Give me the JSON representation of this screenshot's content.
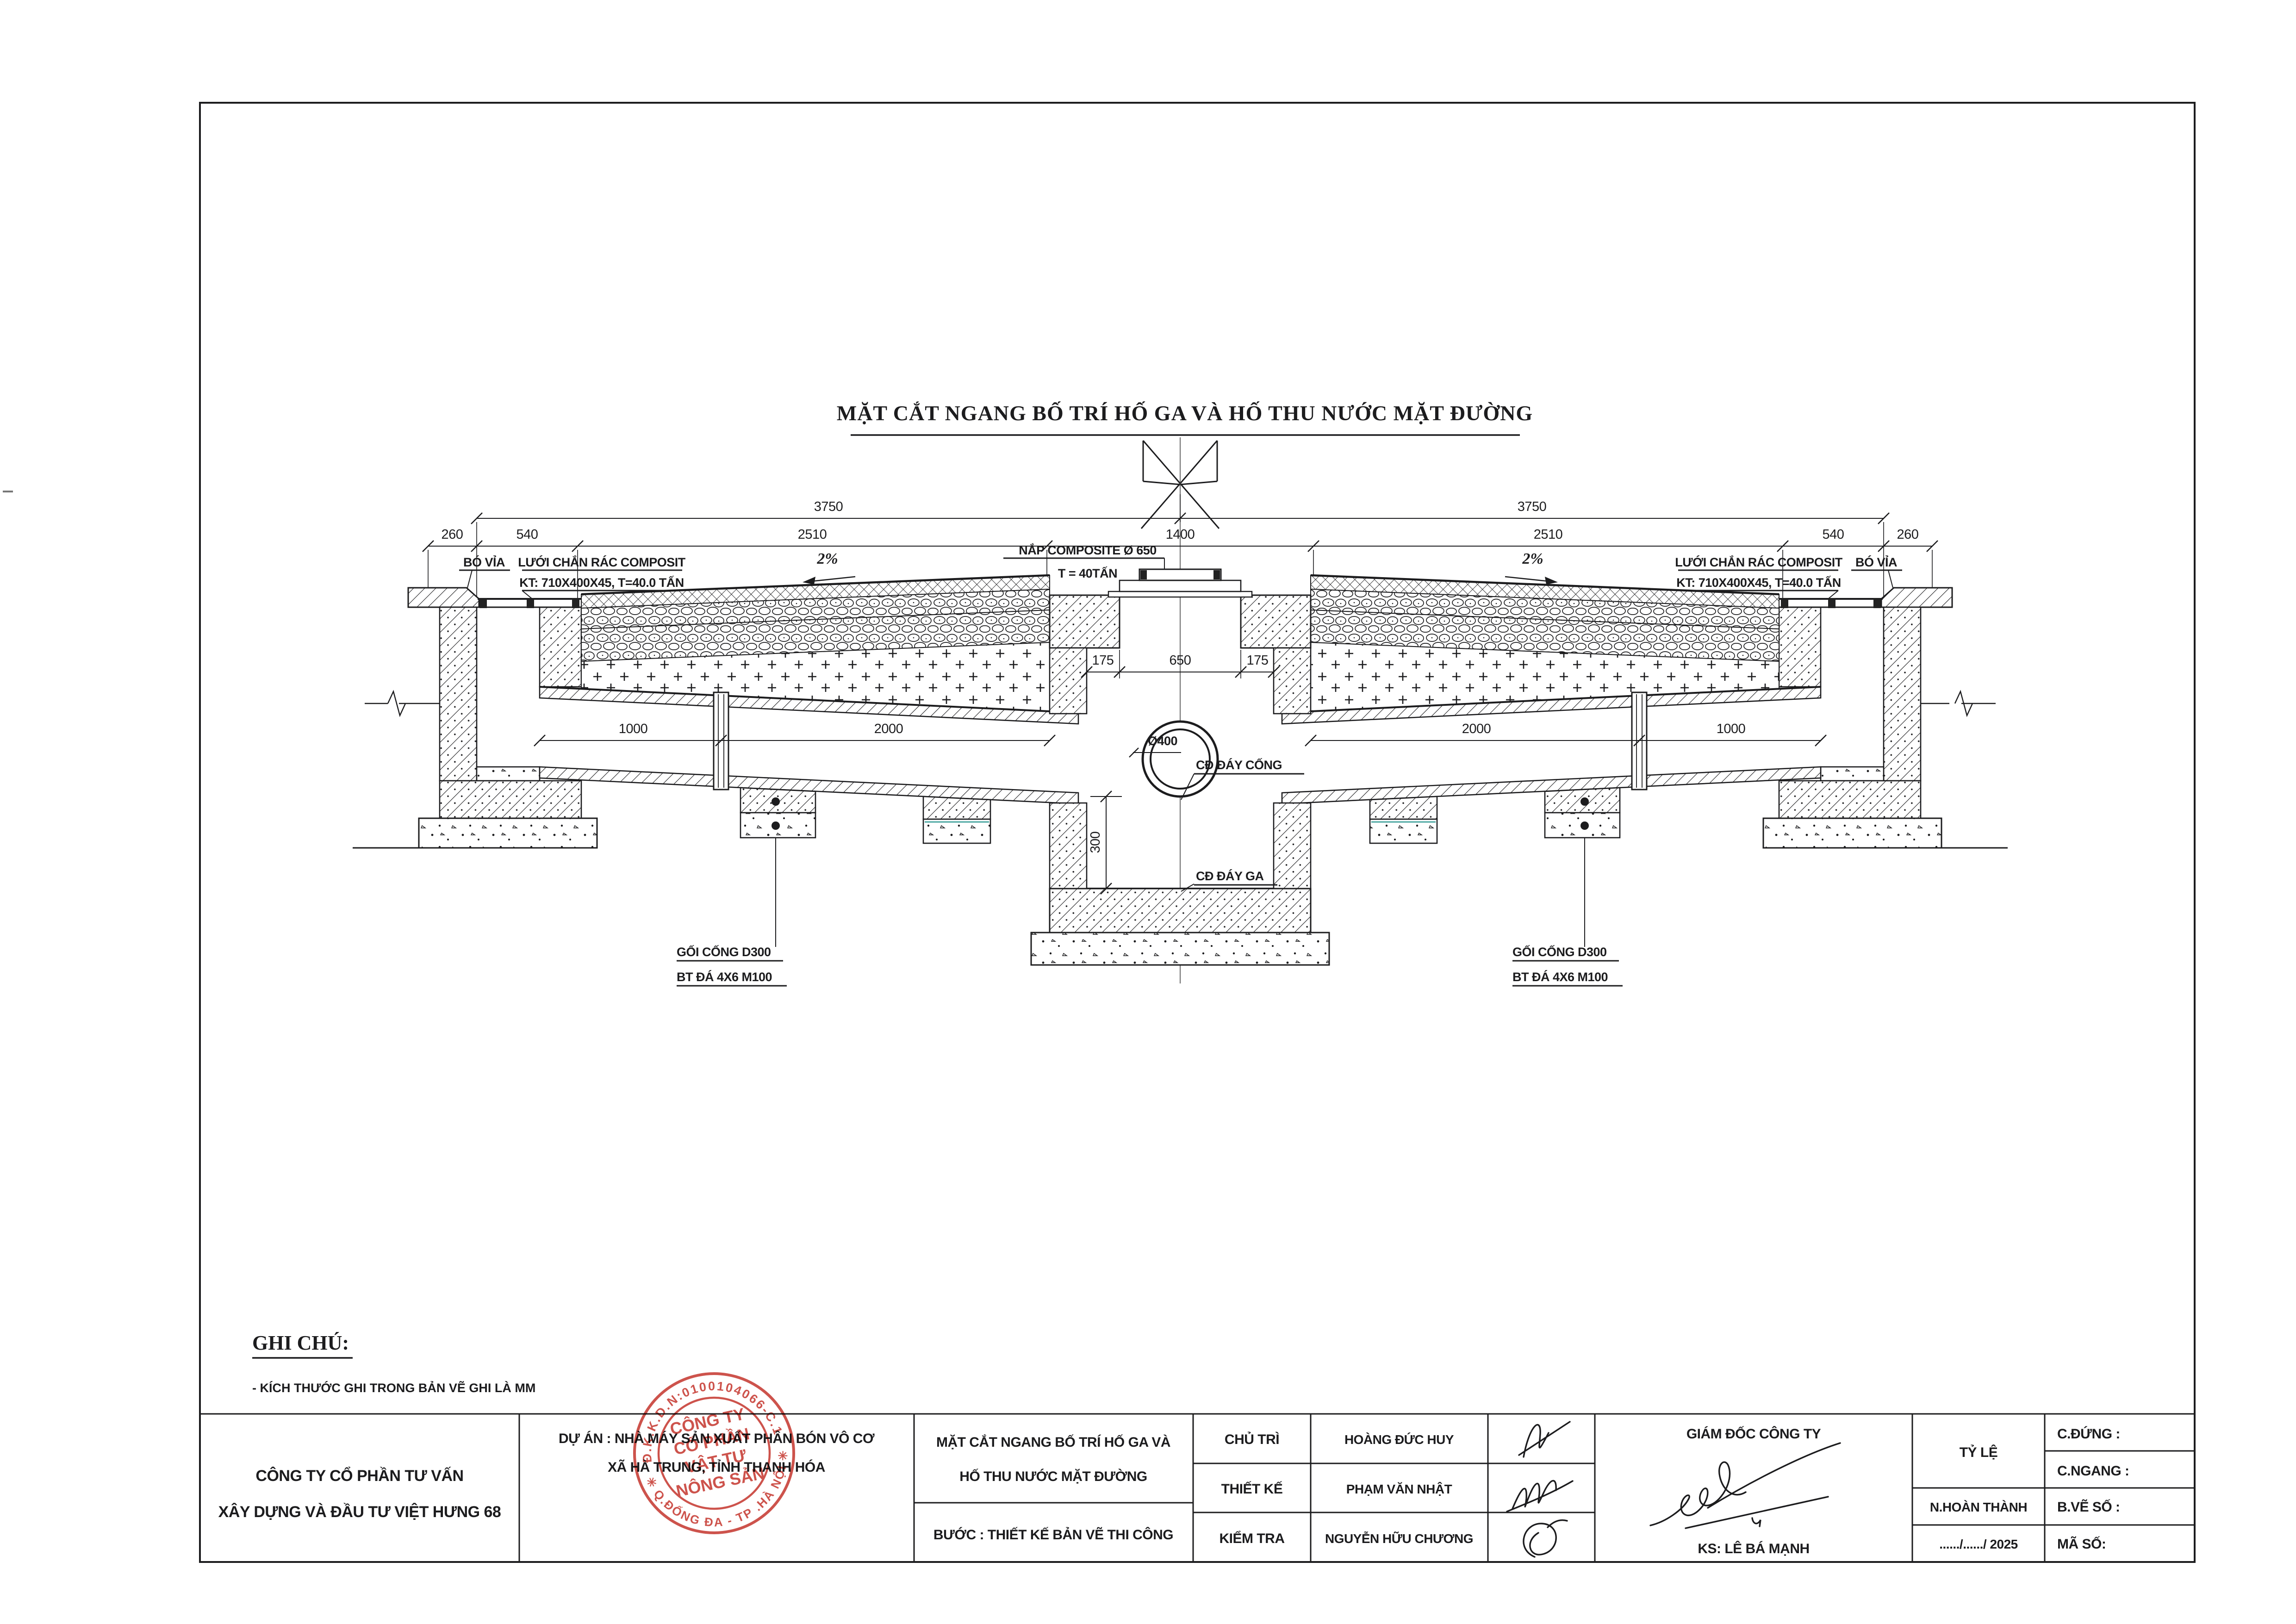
{
  "sheet": {
    "title": "MẶT CẮT NGANG BỐ TRÍ HỐ GA VÀ HỐ THU NƯỚC MẶT ĐƯỜNG",
    "notes": {
      "heading": "GHI CHÚ:",
      "item1": "- KÍCH THƯỚC GHI TRONG BẢN VẼ GHI LÀ MM"
    }
  },
  "dims": {
    "overall": "3750",
    "curb": "260",
    "gully": "540",
    "lane": "2510",
    "center": "1400",
    "pipe_short": "1000",
    "pipe_long": "2000",
    "wall": "175",
    "neck": "650",
    "depth": "300"
  },
  "labels": {
    "bo_via": "BÓ VỈA",
    "grate_line1": "LƯỚI CHẮN RÁC COMPOSIT",
    "grate_line2": "KT: 710X400X45, T=40.0 TẤN",
    "slope": "2%",
    "cover_line1": "NẮP COMPOSITE Ø 650",
    "cover_line2": "T = 40TẤN",
    "pipe_dia": "Ø400",
    "invert_pipe": "CĐ ĐÁY CỐNG",
    "invert_manhole": "CĐ ĐÁY GA",
    "support_line1": "GỐI CỐNG D300",
    "support_line2": "BT ĐÁ 4X6 M100"
  },
  "title_block": {
    "company_line1": "CÔNG TY CỔ  PHẦN TƯ VẤN",
    "company_line2": "XÂY DỰNG VÀ ĐẦU TƯ VIỆT HƯNG 68",
    "project_line1": "DỰ ÁN : NHÀ MÁY SẢN XUẤT PHÂN BÓN VÔ CƠ",
    "project_line2": "XÃ  HÀ TRUNG, TỈNH THANH HÓA",
    "drawing_line1": "MẶT CẮT NGANG BỐ TRÍ HỐ GA VÀ",
    "drawing_line2": "HỐ THU NƯỚC MẶT ĐƯỜNG",
    "stage": "BƯỚC : THIẾT KẾ BẢN VẼ THI CÔNG",
    "roles": [
      {
        "label": "CHỦ TRÌ",
        "name": "HOÀNG ĐỨC HUY"
      },
      {
        "label": "THIẾT KẾ",
        "name": "PHẠM VĂN NHẬT"
      },
      {
        "label": "KIỂM TRA",
        "name": "NGUYỄN HỮU CHƯƠNG"
      }
    ],
    "director_title": "GIÁM ĐỐC CÔNG TY",
    "director_name": "KS: LÊ BÁ MẠNH",
    "scale_label": "TỶ LỆ",
    "fields": {
      "c_dung": "C.ĐỨNG :",
      "c_ngang": "C.NGANG :",
      "n_hoan_thanh": "N.HOÀN THÀNH",
      "b_ve_so": "B.VẼ SỐ :",
      "ma_so": "MÃ SỐ:",
      "date": "....../....../ 2025"
    }
  },
  "stamp": {
    "ring_top": "Đ.K.K.D.N:0100104066-C.1",
    "ring_bottom": "✳ Q.ĐỐNG ĐA - TP .HÀ NỘI ✳",
    "inner_line1": "CÔNG TY",
    "inner_line2": "CỔ PHẦN",
    "inner_line3": "VẬT TƯ",
    "inner_line4": "NÔNG SẢN",
    "color": "#c5352c"
  },
  "colors": {
    "ink": "#1c1c1e",
    "paper": "#ffffff",
    "stamp_red": "#c5352c"
  }
}
